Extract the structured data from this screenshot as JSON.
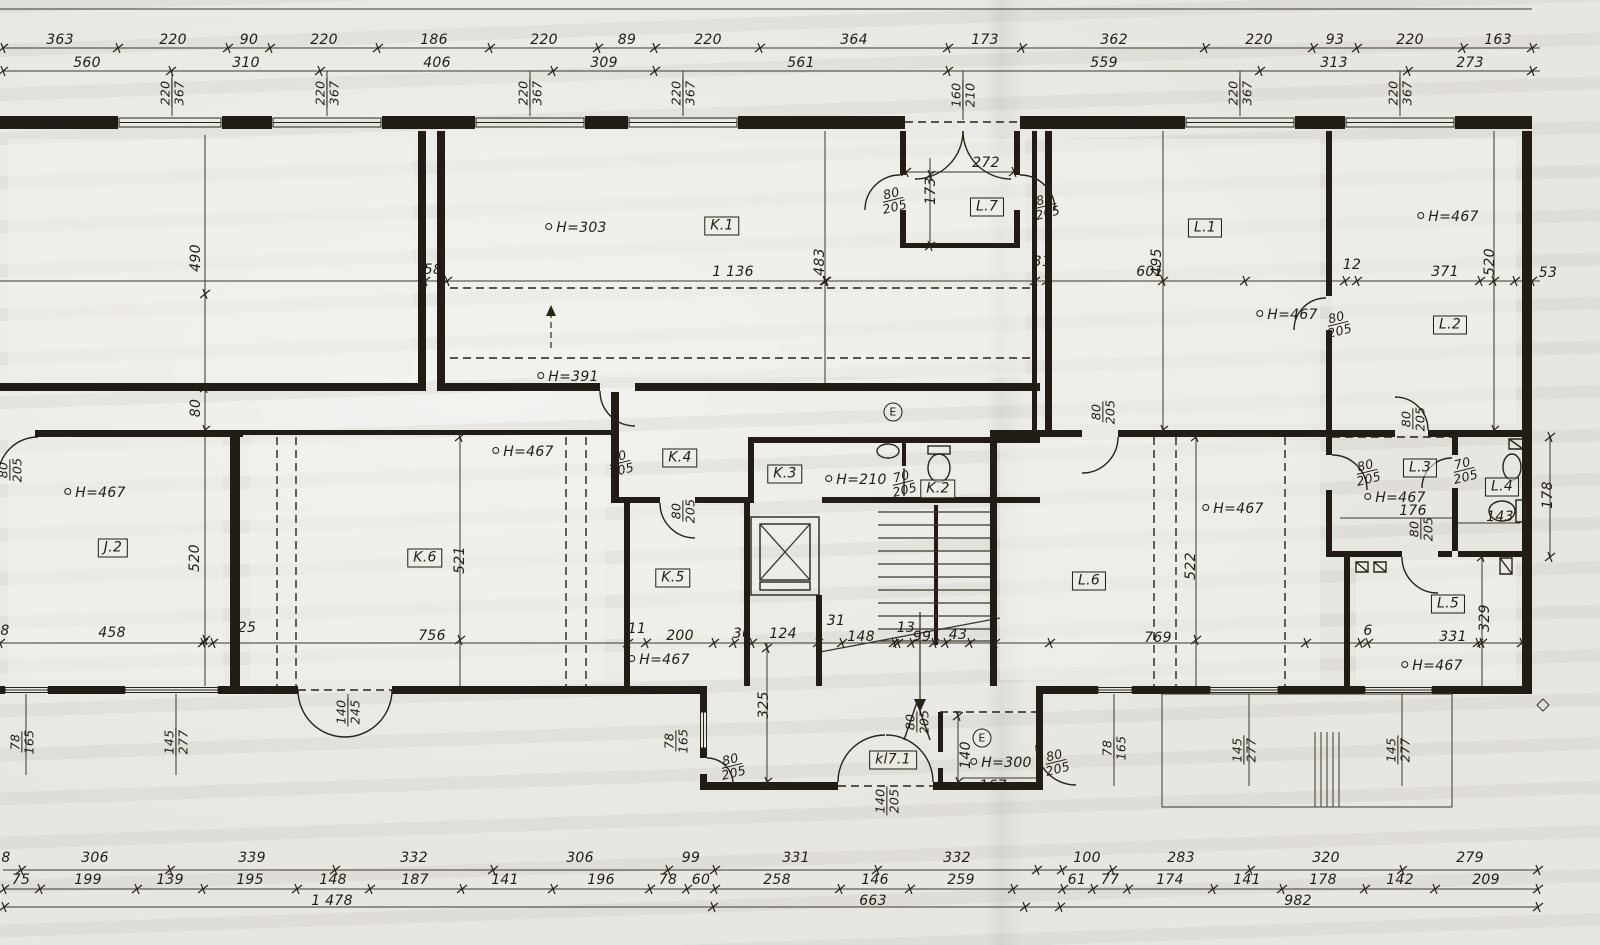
{
  "palette": {
    "paper": "#e8e6e1",
    "ink": "#211d16"
  },
  "drawing": {
    "kind": "architectural floor plan (scanned storey plan)"
  },
  "labels": [
    {
      "k": "dim",
      "t": "363",
      "x": 60,
      "y": 40
    },
    {
      "k": "dim",
      "t": "220",
      "x": 173,
      "y": 40
    },
    {
      "k": "dim",
      "t": "90",
      "x": 249,
      "y": 40
    },
    {
      "k": "dim",
      "t": "220",
      "x": 324,
      "y": 40
    },
    {
      "k": "dim",
      "t": "186",
      "x": 434,
      "y": 40
    },
    {
      "k": "dim",
      "t": "220",
      "x": 544,
      "y": 40
    },
    {
      "k": "dim",
      "t": "89",
      "x": 627,
      "y": 40
    },
    {
      "k": "dim",
      "t": "220",
      "x": 708,
      "y": 40
    },
    {
      "k": "dim",
      "t": "364",
      "x": 854,
      "y": 40
    },
    {
      "k": "dim",
      "t": "173",
      "x": 985,
      "y": 40
    },
    {
      "k": "dim",
      "t": "362",
      "x": 1114,
      "y": 40
    },
    {
      "k": "dim",
      "t": "220",
      "x": 1259,
      "y": 40
    },
    {
      "k": "dim",
      "t": "93",
      "x": 1335,
      "y": 40
    },
    {
      "k": "dim",
      "t": "220",
      "x": 1410,
      "y": 40
    },
    {
      "k": "dim",
      "t": "163",
      "x": 1498,
      "y": 40
    },
    {
      "k": "dim",
      "t": "560",
      "x": 87,
      "y": 63
    },
    {
      "k": "dim",
      "t": "310",
      "x": 246,
      "y": 63
    },
    {
      "k": "dim",
      "t": "406",
      "x": 437,
      "y": 63
    },
    {
      "k": "dim",
      "t": "309",
      "x": 604,
      "y": 63
    },
    {
      "k": "dim",
      "t": "561",
      "x": 801,
      "y": 63
    },
    {
      "k": "dim",
      "t": "559",
      "x": 1104,
      "y": 63
    },
    {
      "k": "dim",
      "t": "313",
      "x": 1334,
      "y": 63
    },
    {
      "k": "dim",
      "t": "273",
      "x": 1470,
      "y": 63
    },
    {
      "k": "frac",
      "num": "220",
      "den": "367",
      "x": 172,
      "y": 93,
      "r": -90
    },
    {
      "k": "frac",
      "num": "220",
      "den": "367",
      "x": 327,
      "y": 93,
      "r": -90
    },
    {
      "k": "frac",
      "num": "220",
      "den": "367",
      "x": 530,
      "y": 93,
      "r": -90
    },
    {
      "k": "frac",
      "num": "220",
      "den": "367",
      "x": 683,
      "y": 93,
      "r": -90
    },
    {
      "k": "frac",
      "num": "160",
      "den": "210",
      "x": 963,
      "y": 95,
      "r": -90
    },
    {
      "k": "frac",
      "num": "220",
      "den": "367",
      "x": 1240,
      "y": 93,
      "r": -90
    },
    {
      "k": "frac",
      "num": "220",
      "den": "367",
      "x": 1400,
      "y": 93,
      "r": -90
    },
    {
      "k": "dim",
      "t": "58",
      "x": 433,
      "y": 270
    },
    {
      "k": "dim",
      "t": "1 136",
      "x": 733,
      "y": 272
    },
    {
      "k": "dim",
      "t": "31",
      "x": 1042,
      "y": 262
    },
    {
      "k": "dim",
      "t": "601",
      "x": 1150,
      "y": 272
    },
    {
      "k": "dim",
      "t": "12",
      "x": 1352,
      "y": 265
    },
    {
      "k": "dim",
      "t": "371",
      "x": 1445,
      "y": 272
    },
    {
      "k": "dim",
      "t": "53",
      "x": 1548,
      "y": 273
    },
    {
      "k": "dim",
      "t": "490",
      "x": 196,
      "y": 258,
      "r": -90
    },
    {
      "k": "dim",
      "t": "483",
      "x": 820,
      "y": 262,
      "r": -90
    },
    {
      "k": "dim",
      "t": "495",
      "x": 1157,
      "y": 262,
      "r": -90
    },
    {
      "k": "dim",
      "t": "520",
      "x": 1490,
      "y": 262,
      "r": -90
    },
    {
      "k": "h",
      "t": "H=303",
      "x": 576,
      "y": 228
    },
    {
      "k": "room",
      "t": "K.1",
      "x": 722,
      "y": 226
    },
    {
      "k": "h",
      "t": "H=391",
      "x": 568,
      "y": 377
    },
    {
      "k": "room",
      "t": "L.7",
      "x": 987,
      "y": 207
    },
    {
      "k": "dim",
      "t": "272",
      "x": 986,
      "y": 163
    },
    {
      "k": "dim",
      "t": "173",
      "x": 931,
      "y": 191,
      "r": -90
    },
    {
      "k": "frac",
      "num": "80",
      "den": "205",
      "x": 893,
      "y": 200,
      "r": -14
    },
    {
      "k": "frac",
      "num": "80",
      "den": "205",
      "x": 1046,
      "y": 206,
      "r": -14
    },
    {
      "k": "room",
      "t": "L.1",
      "x": 1205,
      "y": 228
    },
    {
      "k": "h",
      "t": "H=467",
      "x": 1448,
      "y": 217
    },
    {
      "k": "h",
      "t": "H=467",
      "x": 1287,
      "y": 315
    },
    {
      "k": "frac",
      "num": "80",
      "den": "205",
      "x": 1338,
      "y": 324,
      "r": -14
    },
    {
      "k": "room",
      "t": "L.2",
      "x": 1450,
      "y": 325
    },
    {
      "k": "frac",
      "num": "80",
      "den": "205",
      "x": 10,
      "y": 470,
      "r": -90
    },
    {
      "k": "h",
      "t": "H=467",
      "x": 95,
      "y": 493
    },
    {
      "k": "room",
      "t": "J.2",
      "x": 113,
      "y": 548
    },
    {
      "k": "dim",
      "t": "80",
      "x": 196,
      "y": 408,
      "r": -90
    },
    {
      "k": "dim",
      "t": "520",
      "x": 195,
      "y": 558,
      "r": -90
    },
    {
      "k": "room",
      "t": "K.6",
      "x": 425,
      "y": 558
    },
    {
      "k": "h",
      "t": "H=467",
      "x": 523,
      "y": 452
    },
    {
      "k": "dim",
      "t": "521",
      "x": 460,
      "y": 560,
      "r": -90
    },
    {
      "k": "frac",
      "num": "80",
      "den": "205",
      "x": 620,
      "y": 463,
      "r": -14
    },
    {
      "k": "room",
      "t": "K.4",
      "x": 680,
      "y": 458
    },
    {
      "k": "frac",
      "num": "80",
      "den": "205",
      "x": 683,
      "y": 511,
      "r": -90
    },
    {
      "k": "room",
      "t": "K.3",
      "x": 785,
      "y": 474
    },
    {
      "k": "h",
      "t": "H=210",
      "x": 856,
      "y": 480
    },
    {
      "k": "mark",
      "t": "E",
      "x": 893,
      "y": 412
    },
    {
      "k": "frac",
      "num": "70",
      "den": "205",
      "x": 903,
      "y": 483,
      "r": -14
    },
    {
      "k": "room",
      "t": "K.2",
      "x": 938,
      "y": 489
    },
    {
      "k": "room",
      "t": "K.5",
      "x": 673,
      "y": 578
    },
    {
      "k": "h",
      "t": "H=467",
      "x": 659,
      "y": 660
    },
    {
      "k": "frac",
      "num": "80",
      "den": "205",
      "x": 1103,
      "y": 412,
      "r": -90
    },
    {
      "k": "h",
      "t": "H=467",
      "x": 1233,
      "y": 509
    },
    {
      "k": "room",
      "t": "L.6",
      "x": 1089,
      "y": 581
    },
    {
      "k": "dim",
      "t": "522",
      "x": 1191,
      "y": 566,
      "r": -90
    },
    {
      "k": "frac",
      "num": "80",
      "den": "205",
      "x": 1413,
      "y": 419,
      "r": -90
    },
    {
      "k": "frac",
      "num": "80",
      "den": "205",
      "x": 1367,
      "y": 472,
      "r": -14
    },
    {
      "k": "room",
      "t": "L.3",
      "x": 1420,
      "y": 468
    },
    {
      "k": "frac",
      "num": "70",
      "den": "205",
      "x": 1464,
      "y": 470,
      "r": -14
    },
    {
      "k": "h",
      "t": "H=467",
      "x": 1395,
      "y": 498
    },
    {
      "k": "dim",
      "t": "176",
      "x": 1413,
      "y": 511
    },
    {
      "k": "frac",
      "num": "80",
      "den": "205",
      "x": 1421,
      "y": 529,
      "r": -90
    },
    {
      "k": "room",
      "t": "L.4",
      "x": 1502,
      "y": 487
    },
    {
      "k": "dim",
      "t": "143",
      "x": 1500,
      "y": 517
    },
    {
      "k": "dim",
      "t": "178",
      "x": 1548,
      "y": 495,
      "r": -90
    },
    {
      "k": "room",
      "t": "L.5",
      "x": 1448,
      "y": 604
    },
    {
      "k": "dim",
      "t": "329",
      "x": 1485,
      "y": 618,
      "r": -90
    },
    {
      "k": "h",
      "t": "H=467",
      "x": 1432,
      "y": 666
    },
    {
      "k": "dim",
      "t": "8",
      "x": 5,
      "y": 631
    },
    {
      "k": "dim",
      "t": "458",
      "x": 112,
      "y": 633
    },
    {
      "k": "dim",
      "t": "25",
      "x": 247,
      "y": 628
    },
    {
      "k": "dim",
      "t": "756",
      "x": 432,
      "y": 636
    },
    {
      "k": "dim",
      "t": "11",
      "x": 637,
      "y": 629
    },
    {
      "k": "dim",
      "t": "200",
      "x": 680,
      "y": 636
    },
    {
      "k": "dim",
      "t": "36",
      "x": 742,
      "y": 634
    },
    {
      "k": "dim",
      "t": "124",
      "x": 783,
      "y": 634
    },
    {
      "k": "dim",
      "t": "31",
      "x": 836,
      "y": 621
    },
    {
      "k": "dim",
      "t": "148",
      "x": 861,
      "y": 637
    },
    {
      "k": "dim",
      "t": "13",
      "x": 906,
      "y": 628
    },
    {
      "k": "dim",
      "t": "99",
      "x": 922,
      "y": 637
    },
    {
      "k": "dim",
      "t": "43",
      "x": 958,
      "y": 635
    },
    {
      "k": "dim",
      "t": "769",
      "x": 1158,
      "y": 638
    },
    {
      "k": "dim",
      "t": "6",
      "x": 1368,
      "y": 631
    },
    {
      "k": "dim",
      "t": "331",
      "x": 1453,
      "y": 637
    },
    {
      "k": "dim",
      "t": "325",
      "x": 764,
      "y": 705,
      "r": -90
    },
    {
      "k": "frac",
      "num": "80",
      "den": "205",
      "x": 732,
      "y": 766,
      "r": -14
    },
    {
      "k": "frac",
      "num": "78",
      "den": "165",
      "x": 676,
      "y": 741,
      "r": -90
    },
    {
      "k": "room",
      "t": "kl7.1",
      "x": 893,
      "y": 760
    },
    {
      "k": "frac",
      "num": "80",
      "den": "205",
      "x": 917,
      "y": 722,
      "r": -90
    },
    {
      "k": "frac",
      "num": "140",
      "den": "205",
      "x": 887,
      "y": 801,
      "r": -90
    },
    {
      "k": "dim",
      "t": "140",
      "x": 966,
      "y": 755,
      "r": -90
    },
    {
      "k": "h",
      "t": "H=300",
      "x": 1001,
      "y": 763
    },
    {
      "k": "dim",
      "t": "167",
      "x": 993,
      "y": 786
    },
    {
      "k": "mark",
      "t": "E",
      "x": 982,
      "y": 738
    },
    {
      "k": "frac",
      "num": "80",
      "den": "205",
      "x": 1056,
      "y": 762,
      "r": -14
    },
    {
      "k": "frac",
      "num": "140",
      "den": "245",
      "x": 348,
      "y": 712,
      "r": -90
    },
    {
      "k": "frac",
      "num": "78",
      "den": "165",
      "x": 22,
      "y": 742,
      "r": -90
    },
    {
      "k": "frac",
      "num": "145",
      "den": "277",
      "x": 176,
      "y": 742,
      "r": -90
    },
    {
      "k": "frac",
      "num": "78",
      "den": "165",
      "x": 1114,
      "y": 748,
      "r": -90
    },
    {
      "k": "frac",
      "num": "145",
      "den": "277",
      "x": 1244,
      "y": 750,
      "r": -90
    },
    {
      "k": "frac",
      "num": "145",
      "den": "277",
      "x": 1398,
      "y": 750,
      "r": -90
    },
    {
      "k": "dim",
      "t": "8",
      "x": 6,
      "y": 858
    },
    {
      "k": "dim",
      "t": "306",
      "x": 95,
      "y": 858
    },
    {
      "k": "dim",
      "t": "339",
      "x": 252,
      "y": 858
    },
    {
      "k": "dim",
      "t": "332",
      "x": 414,
      "y": 858
    },
    {
      "k": "dim",
      "t": "306",
      "x": 580,
      "y": 858
    },
    {
      "k": "dim",
      "t": "99",
      "x": 691,
      "y": 858
    },
    {
      "k": "dim",
      "t": "331",
      "x": 796,
      "y": 858
    },
    {
      "k": "dim",
      "t": "332",
      "x": 957,
      "y": 858
    },
    {
      "k": "dim",
      "t": "100",
      "x": 1087,
      "y": 858
    },
    {
      "k": "dim",
      "t": "283",
      "x": 1181,
      "y": 858
    },
    {
      "k": "dim",
      "t": "320",
      "x": 1326,
      "y": 858
    },
    {
      "k": "dim",
      "t": "279",
      "x": 1470,
      "y": 858
    },
    {
      "k": "dim",
      "t": "75",
      "x": 21,
      "y": 880
    },
    {
      "k": "dim",
      "t": "199",
      "x": 88,
      "y": 880
    },
    {
      "k": "dim",
      "t": "139",
      "x": 170,
      "y": 880
    },
    {
      "k": "dim",
      "t": "195",
      "x": 250,
      "y": 880
    },
    {
      "k": "dim",
      "t": "148",
      "x": 333,
      "y": 880
    },
    {
      "k": "dim",
      "t": "187",
      "x": 415,
      "y": 880
    },
    {
      "k": "dim",
      "t": "141",
      "x": 505,
      "y": 880
    },
    {
      "k": "dim",
      "t": "196",
      "x": 601,
      "y": 880
    },
    {
      "k": "dim",
      "t": "78",
      "x": 668,
      "y": 880
    },
    {
      "k": "dim",
      "t": "60",
      "x": 701,
      "y": 880
    },
    {
      "k": "dim",
      "t": "258",
      "x": 777,
      "y": 880
    },
    {
      "k": "dim",
      "t": "146",
      "x": 875,
      "y": 880
    },
    {
      "k": "dim",
      "t": "259",
      "x": 961,
      "y": 880
    },
    {
      "k": "dim",
      "t": "61",
      "x": 1077,
      "y": 880
    },
    {
      "k": "dim",
      "t": "77",
      "x": 1110,
      "y": 880
    },
    {
      "k": "dim",
      "t": "174",
      "x": 1170,
      "y": 880
    },
    {
      "k": "dim",
      "t": "141",
      "x": 1247,
      "y": 880
    },
    {
      "k": "dim",
      "t": "178",
      "x": 1323,
      "y": 880
    },
    {
      "k": "dim",
      "t": "142",
      "x": 1400,
      "y": 880
    },
    {
      "k": "dim",
      "t": "209",
      "x": 1486,
      "y": 880
    },
    {
      "k": "dim",
      "t": "1 478",
      "x": 332,
      "y": 901
    },
    {
      "k": "dim",
      "t": "663",
      "x": 873,
      "y": 901
    },
    {
      "k": "dim",
      "t": "982",
      "x": 1298,
      "y": 901
    }
  ]
}
